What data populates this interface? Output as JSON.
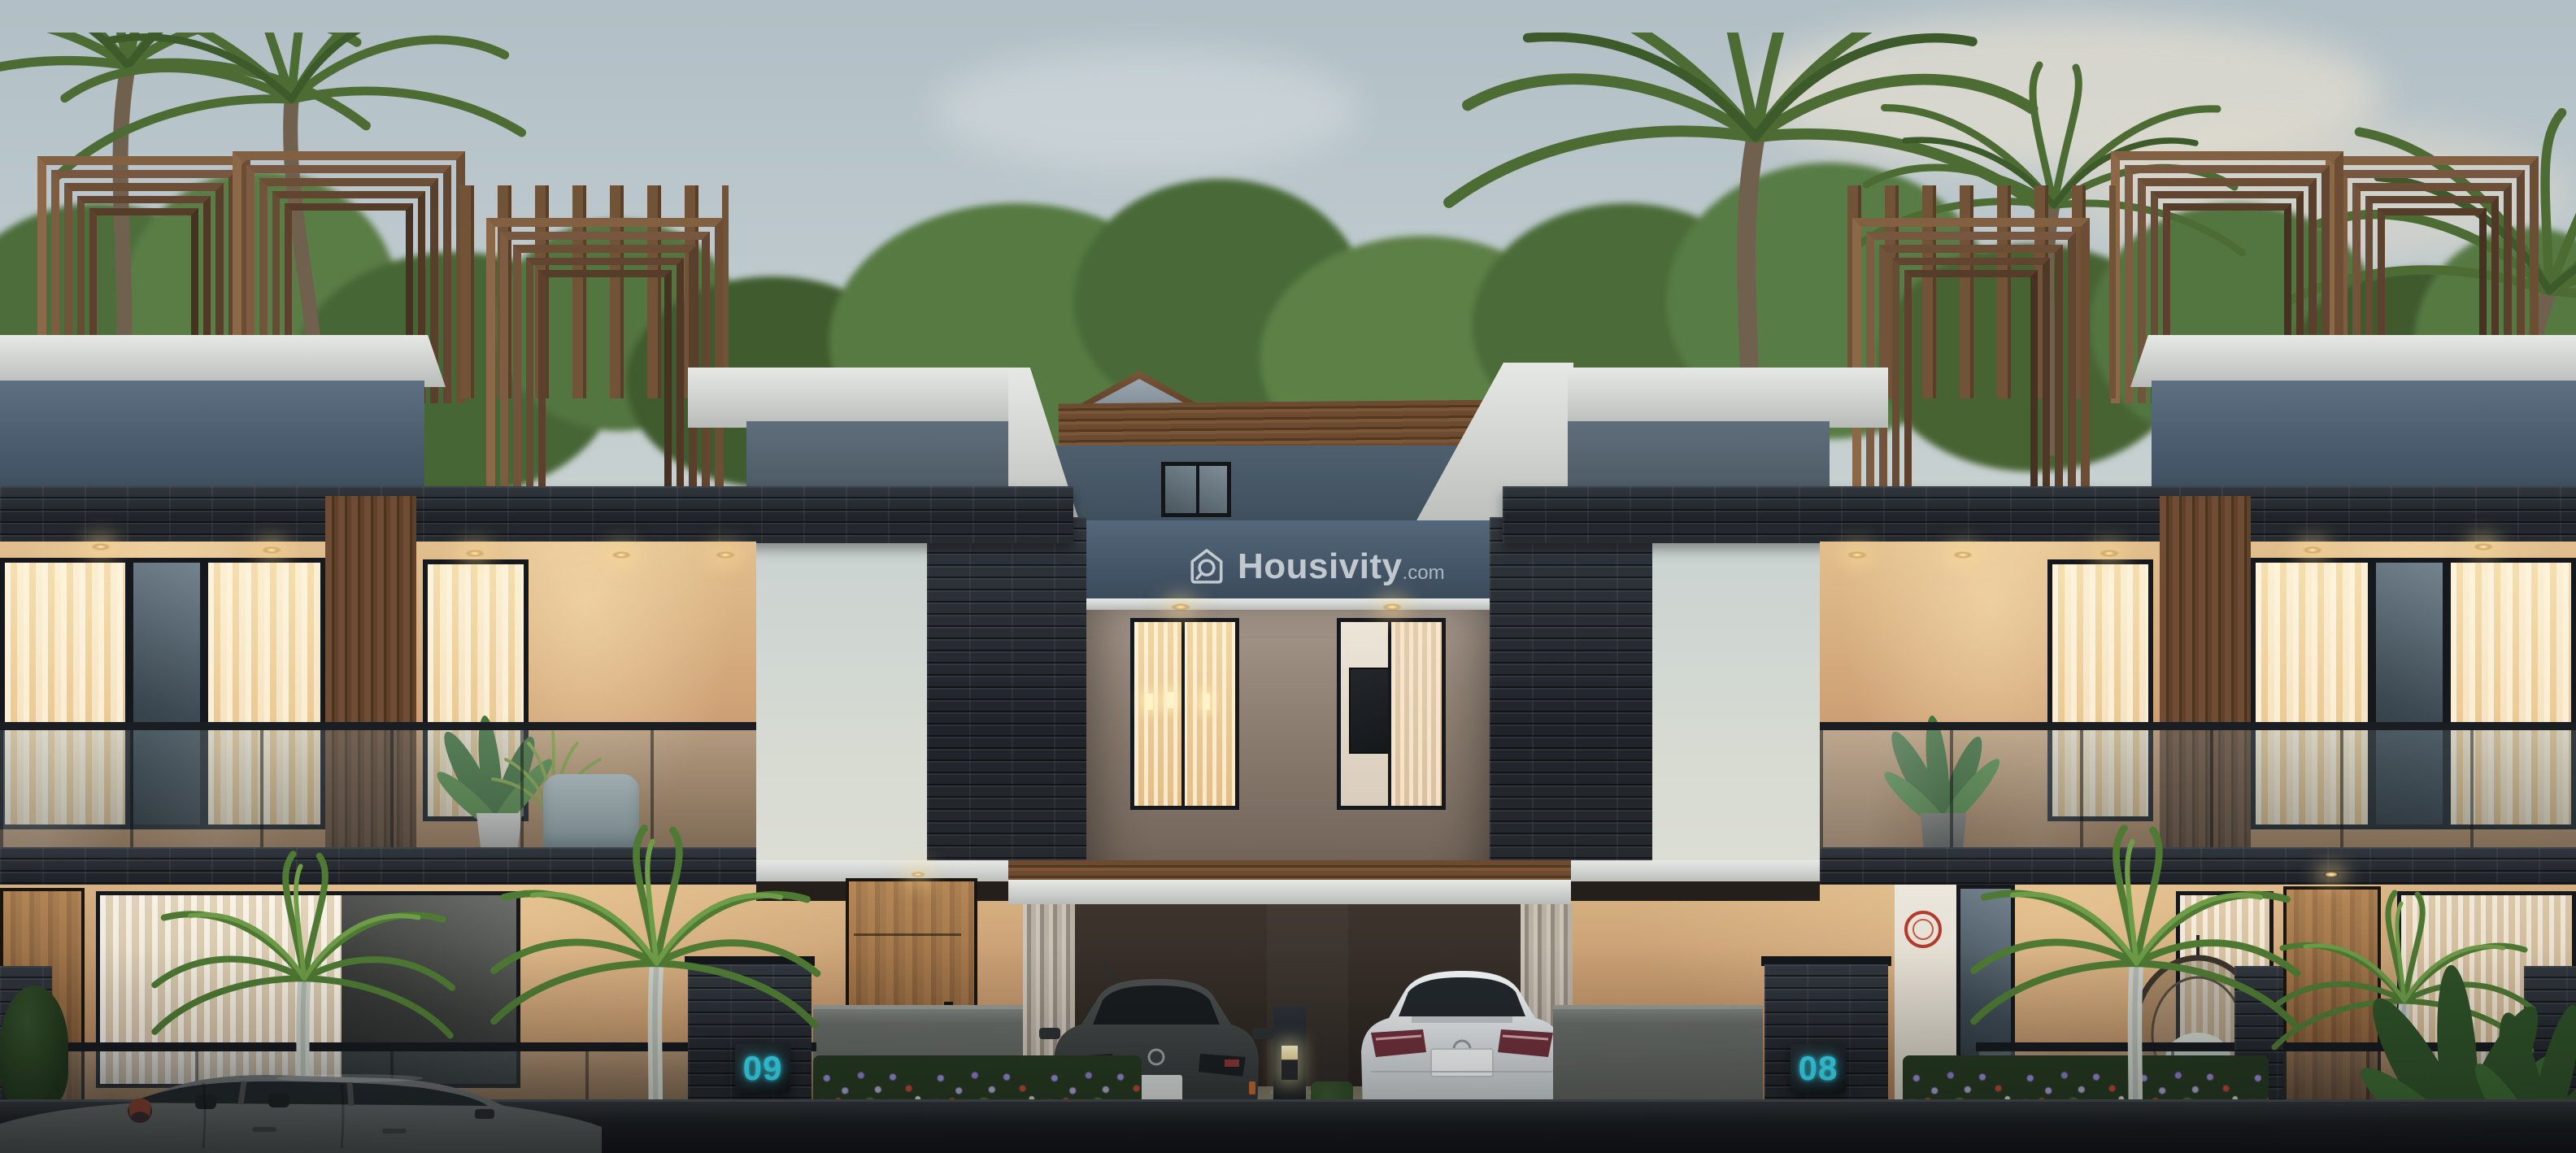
{
  "brand": {
    "watermark": "Housivity",
    "watermark_suffix": ".com",
    "logo_icon": "house-magnifier-icon"
  },
  "houses": [
    {
      "position": "left",
      "number": "09"
    },
    {
      "position": "right",
      "number": "08"
    }
  ],
  "palette": {
    "accent_cyan": "#39dcf4",
    "sky_top": "#b1bfc6",
    "sky_horizon": "#dedfd5",
    "white_band": "#d8dad6",
    "blue_wall": "#4a5c6d",
    "stone_dark": "#23282e",
    "wood": "#74533a",
    "warm_glow": "#f2d9a8",
    "asphalt": "#17191c"
  }
}
